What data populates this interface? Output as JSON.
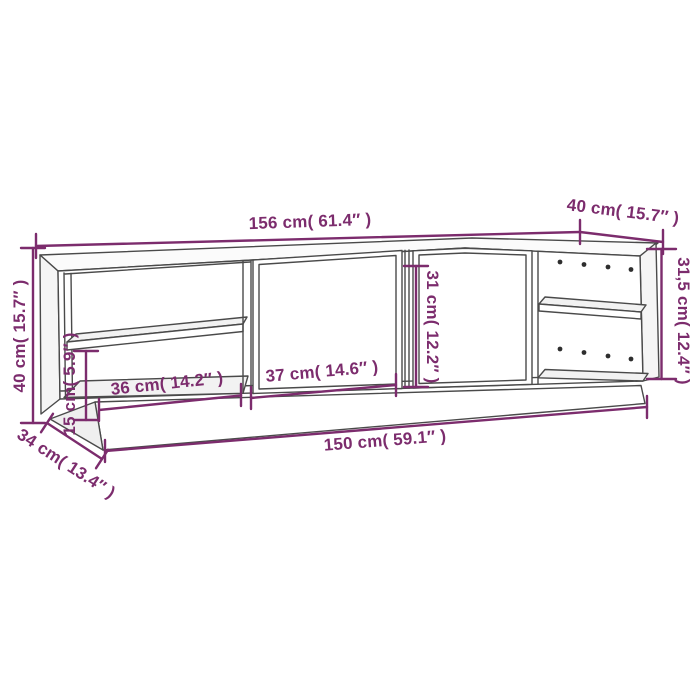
{
  "diagram": {
    "kind": "furniture-dimension-diagram",
    "colors": {
      "dimension_accent": "#7c2c6d",
      "outline": "#4a4a4a",
      "background": "#ffffff",
      "knot_dots": "#2e2e2e"
    },
    "dimensions": {
      "top_width": {
        "label": "156 cm( 61.4″ )"
      },
      "top_depth": {
        "label": "40 cm( 15.7″ )"
      },
      "right_height": {
        "label": "31,5 cm( 12.4″ )"
      },
      "left_height": {
        "label": "40 cm( 15.7″ )"
      },
      "left_clearance": {
        "label": "15 cm( 5.9″ )"
      },
      "base_depth": {
        "label": "34 cm( 13.4″ )"
      },
      "left_compartment_width": {
        "label": "36 cm( 14.2″ )"
      },
      "door_width": {
        "label": "37 cm( 14.6″ )"
      },
      "door_height": {
        "label": "31 cm( 12.2″ )"
      },
      "base_width": {
        "label": "150 cm( 59.1″ )"
      }
    }
  }
}
